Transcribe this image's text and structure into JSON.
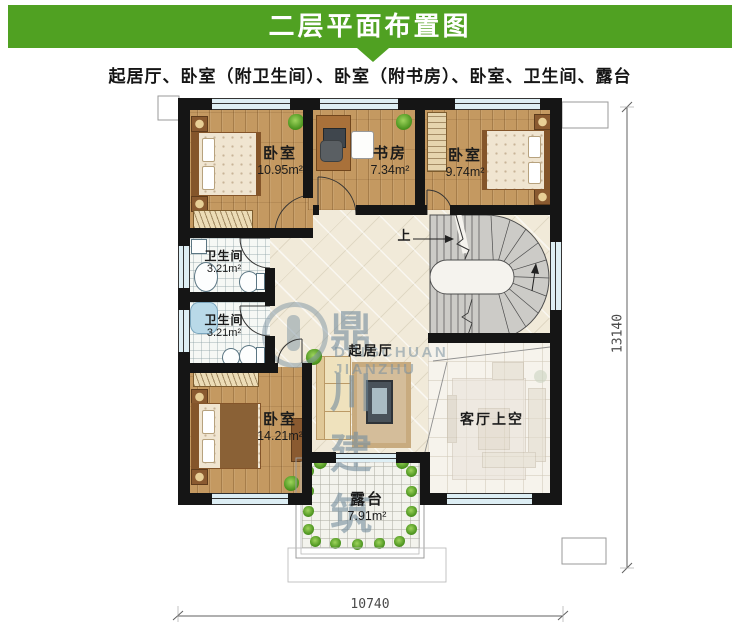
{
  "header": {
    "title": "二层平面布置图"
  },
  "subtitle": "起居厅、卧室（附卫生间）、卧室（附书房）、卧室、卫生间、露台",
  "rooms": {
    "bedroom_tl": {
      "name": "卧室",
      "area": "10.95m²"
    },
    "study": {
      "name": "书房",
      "area": "7.34m²"
    },
    "bedroom_tr": {
      "name": "卧室",
      "area": "9.74m²"
    },
    "bath_upper": {
      "name": "卫生间",
      "area": "3.21m²"
    },
    "bath_lower": {
      "name": "卫生间",
      "area": "3.21m²"
    },
    "bedroom_bl": {
      "name": "卧室",
      "area": "14.21m²"
    },
    "living": {
      "name": "起居厅"
    },
    "void": {
      "name": "客厅上空"
    },
    "terrace": {
      "name": "露台",
      "area": "7.91m²"
    }
  },
  "stairs": {
    "direction_label": "上"
  },
  "dimensions": {
    "width_mm": "10740",
    "height_mm": "13140"
  },
  "watermark": {
    "brand_cn": "鼎川建筑",
    "brand_en": "DINGCHUAN JIANZHU"
  },
  "colors": {
    "accent_green": "#50a122",
    "wall": "#151515",
    "wood_floor": "#c49961",
    "tile": "#f1ead9",
    "stair": "#cccbc7",
    "window": "#ddeef4"
  }
}
